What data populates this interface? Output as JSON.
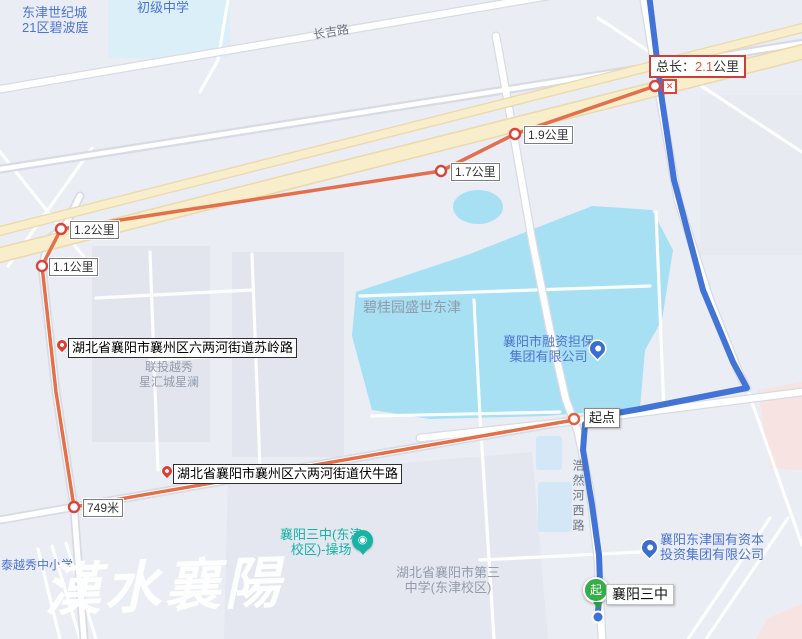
{
  "measure_route": {
    "total": {
      "prefix": "总长：",
      "value": "2.1",
      "unit": "公里"
    },
    "markers": [
      {
        "text": "1.9公里"
      },
      {
        "text": "1.7公里"
      },
      {
        "text": "1.2公里"
      },
      {
        "text": "1.1公里"
      },
      {
        "text": "749米"
      }
    ],
    "start_point_label": "起点",
    "close_glyph": "✕"
  },
  "nav_route": {
    "destination": {
      "glyph": "起",
      "label": "襄阳三中"
    }
  },
  "street_callouts": [
    {
      "text": "湖北省襄阳市襄州区六两河街道苏岭路"
    },
    {
      "text": "湖北省襄阳市襄州区六两河街道伏牛路"
    }
  ],
  "road_names": [
    {
      "text": "长吉路"
    },
    {
      "text": "浩然河西路"
    }
  ],
  "pois": [
    {
      "line1": "东津世纪城",
      "line2": "21区碧波庭"
    },
    {
      "line1": "初级中学"
    },
    {
      "line1": "碧桂园盛世东津"
    },
    {
      "line1": "联投越秀",
      "line2": "星汇城星澜"
    },
    {
      "line1": "襄阳市融资担保",
      "line2": "集团有限公司"
    },
    {
      "line1": "襄阳三中(东津",
      "line2": "校区)-操场"
    },
    {
      "line1": "湖北省襄阳市第三",
      "line2": "中学(东津校区)"
    },
    {
      "line1": "襄阳东津国有资本",
      "line2": "投资集团有限公司"
    },
    {
      "line1": "泰越秀中小学"
    }
  ],
  "watermark": "漢水襄陽",
  "colors": {
    "measure_route": "#e4704b",
    "nav_route": "#4273d6",
    "marker_border": "#d9453c",
    "water": "#a7dff3",
    "highway": "#f8eecb",
    "background": "#eaedf3"
  }
}
